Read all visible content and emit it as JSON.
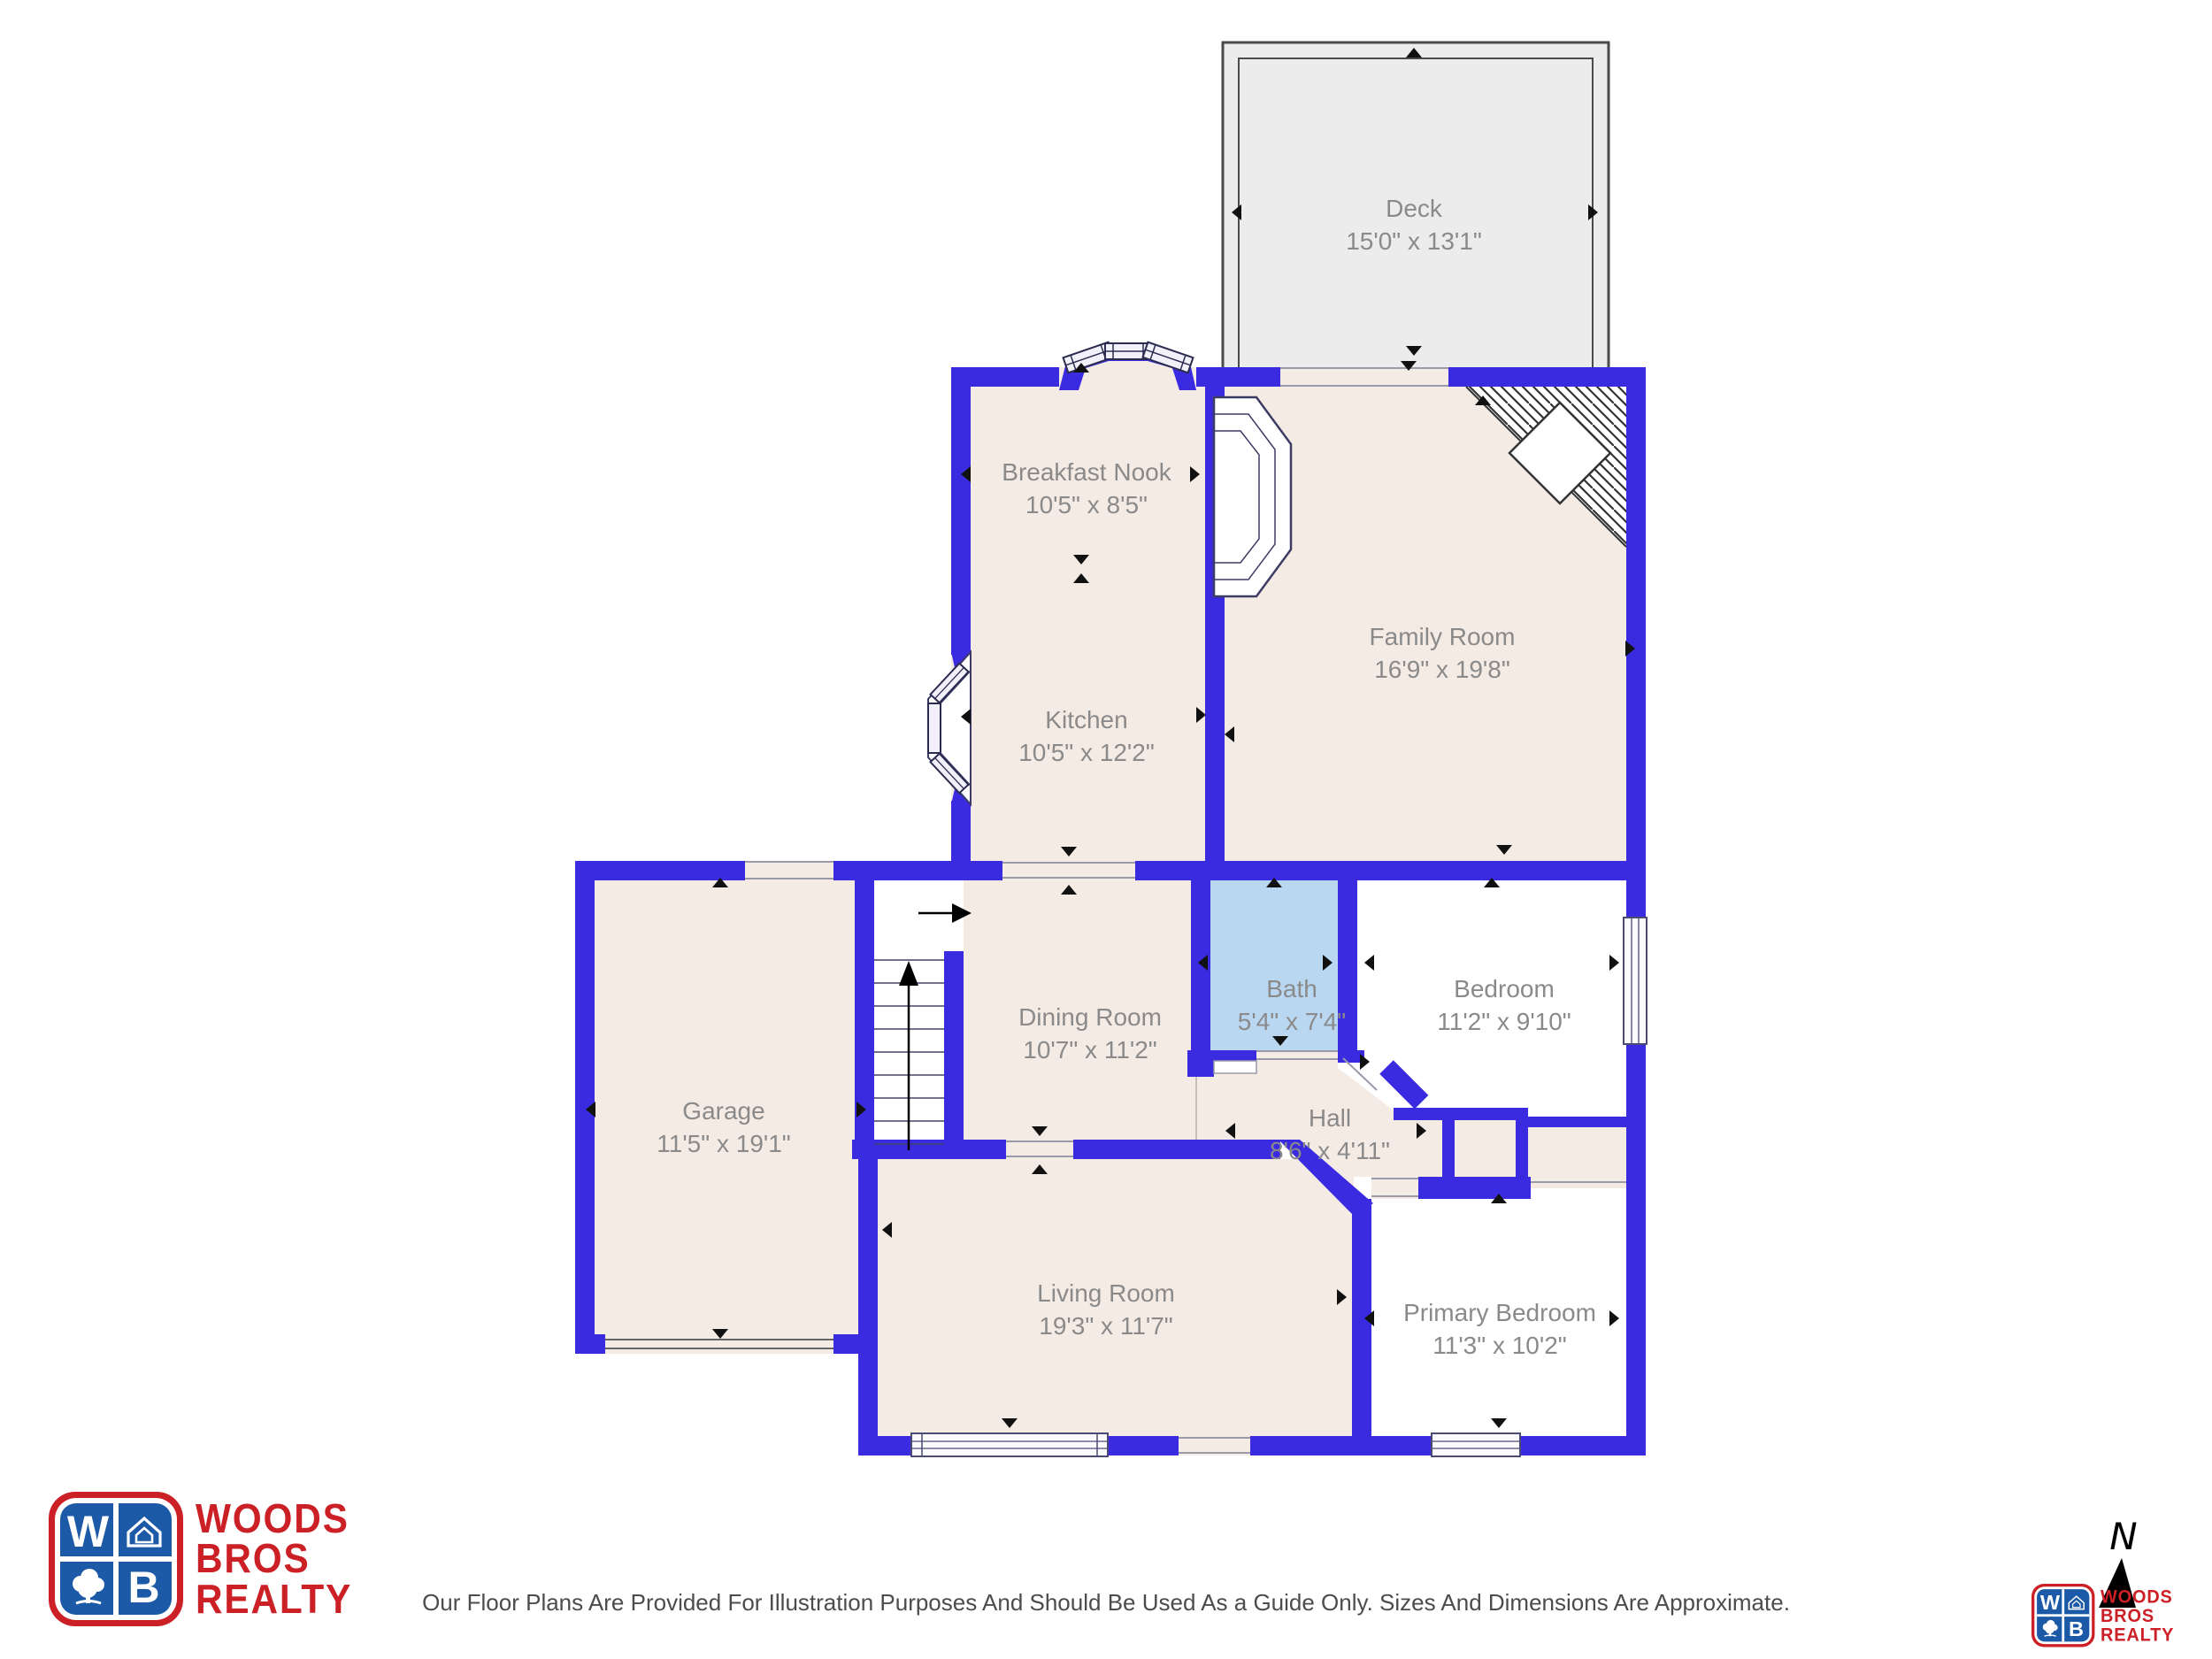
{
  "plan": {
    "rooms": [
      {
        "name": "Deck",
        "dims": "15'0\" x 13'1\""
      },
      {
        "name": "Breakfast Nook",
        "dims": "10'5\" x 8'5\""
      },
      {
        "name": "Kitchen",
        "dims": "10'5\" x 12'2\""
      },
      {
        "name": "Family Room",
        "dims": "16'9\" x 19'8\""
      },
      {
        "name": "Garage",
        "dims": "11'5\" x 19'1\""
      },
      {
        "name": "Dining Room",
        "dims": "10'7\" x 11'2\""
      },
      {
        "name": "Bath",
        "dims": "5'4\" x 7'4\""
      },
      {
        "name": "Bedroom",
        "dims": "11'2\" x 9'10\""
      },
      {
        "name": "Hall",
        "dims": "8'6\" x 4'11\""
      },
      {
        "name": "Living Room",
        "dims": "19'3\" x 11'7\""
      },
      {
        "name": "Primary Bedroom",
        "dims": "11'3\" x 10'2\""
      }
    ],
    "colors": {
      "wall": "#3a2be0",
      "floor": "#f4ebe5",
      "bath_floor": "#b9d7f0",
      "deck_fill": "#ececec",
      "label_text": "#8a8a8a"
    },
    "north_label": "N"
  },
  "branding": {
    "logo_lines": [
      "WOODS",
      "BROS",
      "REALTY"
    ],
    "logo_letters": {
      "w": "W",
      "b": "B"
    },
    "logo_red": "#cc2027",
    "logo_blue": "#1c59a6"
  },
  "footer": {
    "disclaimer": "Our Floor Plans Are Provided For Illustration Purposes And Should Be Used As a Guide Only. Sizes And Dimensions Are Approximate."
  }
}
